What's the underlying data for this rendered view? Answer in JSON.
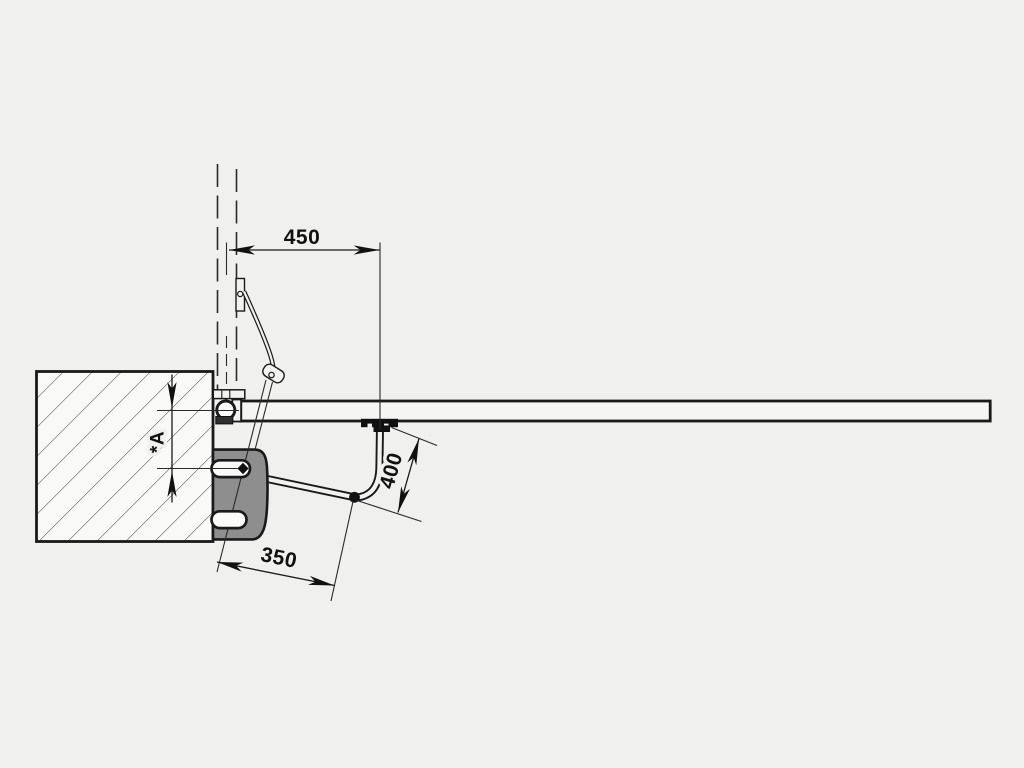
{
  "diagram": {
    "title": "swing-gate-operator-articulated-arm-installation-top-view",
    "dimensions": {
      "gate_attachment_offset": {
        "label": "450"
      },
      "arm_length": {
        "label": "400"
      },
      "post_offset": {
        "label": "350"
      },
      "pivot_to_axis": {
        "label": "*A"
      }
    }
  },
  "colors": {
    "background": "#f0f0ee",
    "line": "#1a1a1a",
    "motor_bracket_gray": "#8e8e8e",
    "surface_light": "#f5f5f3",
    "pillar_fill": "#f9f9f8"
  }
}
